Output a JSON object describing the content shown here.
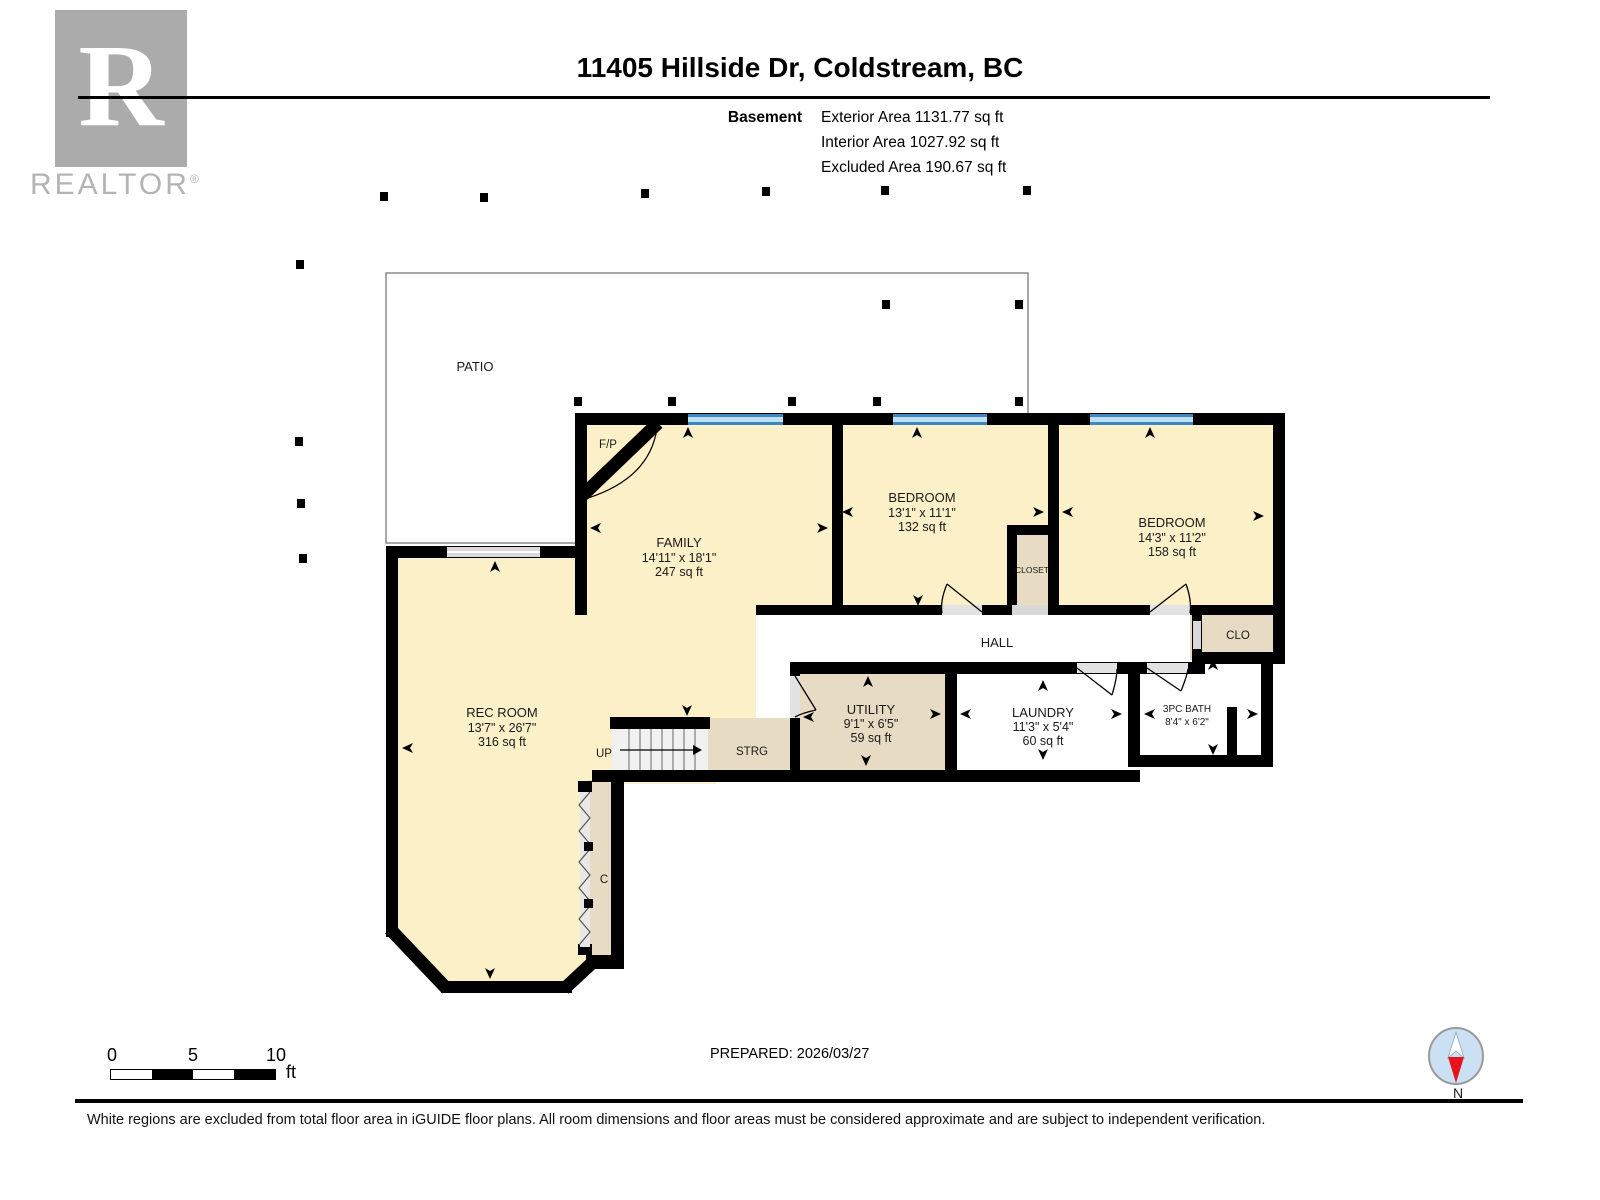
{
  "header": {
    "title": "11405 Hillside Dr, Coldstream, BC",
    "level_label": "Basement",
    "exterior_area": "Exterior Area 1131.77 sq ft",
    "interior_area": "Interior Area 1027.92 sq ft",
    "excluded_area": "Excluded Area 190.67 sq ft"
  },
  "logo": {
    "letter": "R",
    "brand": "REALTOR",
    "reg": "®"
  },
  "plan": {
    "patio": "PATIO",
    "fp": "F/P",
    "hall": "HALL",
    "clo": "CLO",
    "closet": "CLOSET",
    "strg": "STRG",
    "c": "C",
    "up": "UP",
    "rooms": {
      "family": {
        "name": "FAMILY",
        "dims": "14'11\" x 18'1\"",
        "area": "247 sq ft"
      },
      "bedroom1": {
        "name": "BEDROOM",
        "dims": "13'1\" x 11'1\"",
        "area": "132 sq ft"
      },
      "bedroom2": {
        "name": "BEDROOM",
        "dims": "14'3\" x 11'2\"",
        "area": "158 sq ft"
      },
      "rec_room": {
        "name": "REC ROOM",
        "dims": "13'7\" x 26'7\"",
        "area": "316 sq ft"
      },
      "utility": {
        "name": "UTILITY",
        "dims": "9'1\" x 6'5\"",
        "area": "59 sq ft"
      },
      "laundry": {
        "name": "LAUNDRY",
        "dims": "11'3\" x 5'4\"",
        "area": "60 sq ft"
      },
      "bath": {
        "name": "3PC BATH",
        "dims": "8'4\" x 6'2\""
      }
    }
  },
  "scale_bar": {
    "tick0": "0",
    "tick5": "5",
    "tick10": "10",
    "unit": "ft"
  },
  "prepared": "PREPARED: 2026/03/27",
  "compass": {
    "north_label": "N"
  },
  "footer": {
    "disclaimer": "White regions are excluded from total floor area in iGUIDE floor plans. All room dimensions and floor areas must be considered approximate and are subject to independent verification."
  },
  "colors": {
    "room_fill": "#FBF0C8",
    "closet_fill": "#E7DCC3",
    "excluded_fill": "#FFFFFF",
    "wall": "#000000",
    "window_blue": "#3E87C0",
    "window_light": "#BFE0F2",
    "logo_gray": "#ABABAB"
  }
}
